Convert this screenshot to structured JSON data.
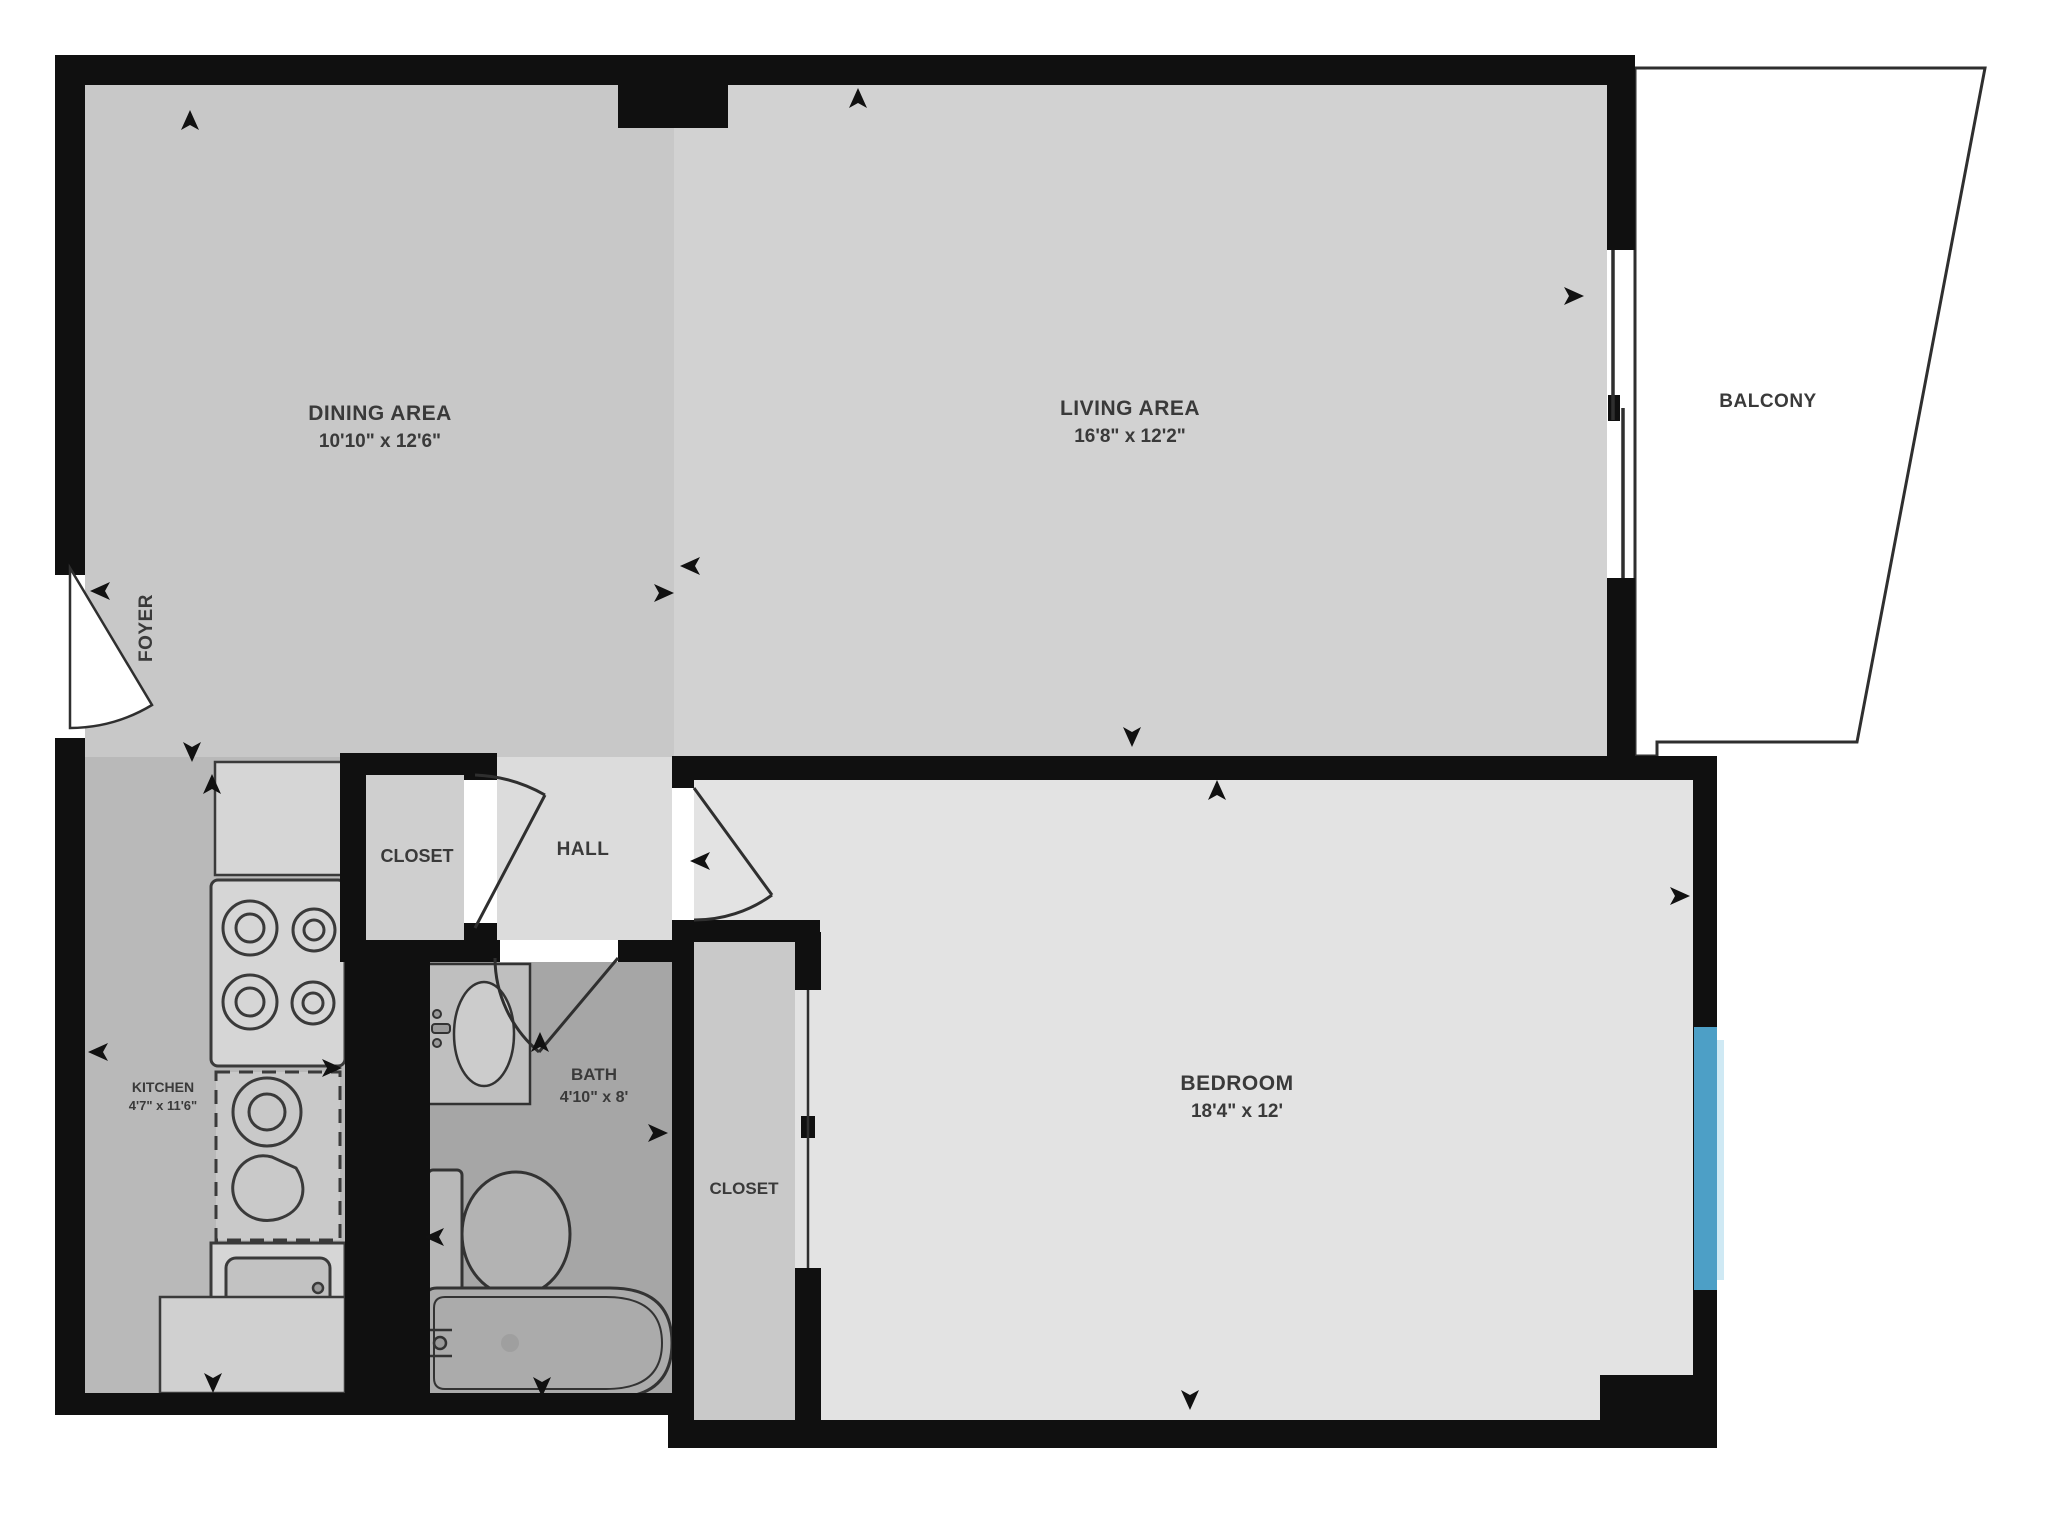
{
  "plan_title": "One-bedroom apartment floor plan",
  "rooms": {
    "dining": {
      "label": "DINING AREA",
      "dims": "10'10\" x 12'6\""
    },
    "living": {
      "label": "LIVING AREA",
      "dims": "16'8\" x 12'2\""
    },
    "balcony": {
      "label": "BALCONY"
    },
    "foyer": {
      "label": "FOYER"
    },
    "hall": {
      "label": "HALL"
    },
    "hall_closet": {
      "label": "CLOSET"
    },
    "kitchen": {
      "label": "KITCHEN",
      "dims": "4'7\" x 11'6\""
    },
    "bath": {
      "label": "BATH",
      "dims": "4'10\" x 8'"
    },
    "bedroom_closet": {
      "label": "CLOSET"
    },
    "bedroom": {
      "label": "BEDROOM",
      "dims": "18'4\" x 12'"
    }
  },
  "colors": {
    "wall": "#101010",
    "outline": "#2f2f2f",
    "window": "#4d9fc6",
    "window_glow": "#cfe9f4",
    "floor_dining": "#c8c8c8",
    "floor_living": "#d2d2d2",
    "floor_bedroom": "#e3e3e3",
    "floor_hall": "#dcdcdc",
    "floor_hall_closet": "#cfcfcf",
    "floor_bedroom_closet": "#c9c9c9",
    "floor_kitchen": "#b9b9b9",
    "floor_bath": "#a6a6a6",
    "balcony_fill": "#ffffff",
    "fixture_fill": "#d6d6d6",
    "fixture_dark": "#b3b3b3",
    "text": "#3a3a3a"
  }
}
